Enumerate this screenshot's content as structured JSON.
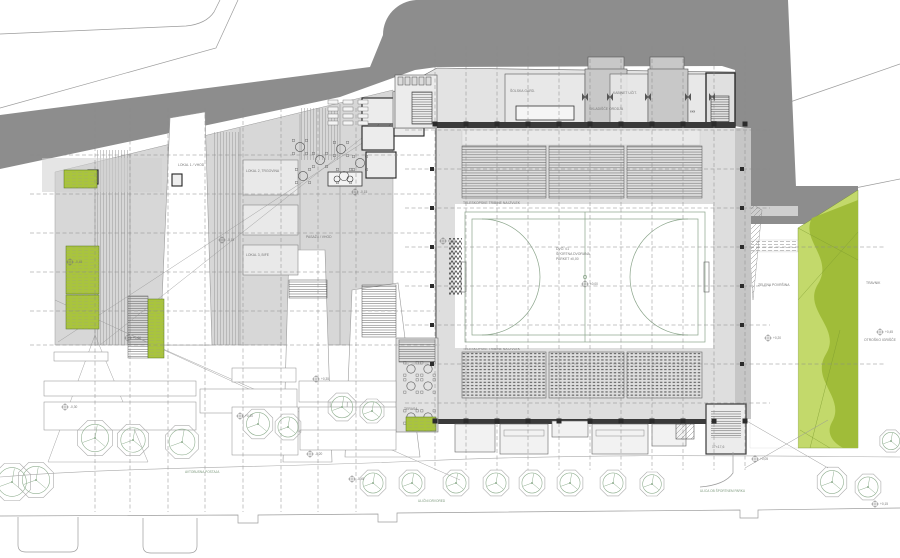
{
  "colors": {
    "road_dark": "#8d8d8d",
    "wing_gray": "#d7d7d7",
    "building_light": "#e3e3e3",
    "room_mid": "#c8c8c8",
    "hall_floor": "#dedede",
    "court_white": "#ffffff",
    "lime": "#a9c43d",
    "green_light": "#c3d96b",
    "green_dark": "#a0bc39",
    "wall_dark": "#3a3a3a",
    "tree_stroke": "#8fae8f"
  },
  "labels": {
    "bleachers_top": "TELESKOPSKE TRIBINE NA IZVLEK",
    "bleachers_bottom": "TELESKOPSKE TRIBINE NA IZVLEK",
    "court_line1": "DVO. 01",
    "court_line2": "ŠPORTNA DVORANA",
    "court_line3": "PARKET  ±0,00",
    "room_top_1": "ŠOLSKA GARD.",
    "room_top_2": "GARDEROBA UČENCI + PRHE",
    "room_top_3": "KABINET UČIT.",
    "room_top_4": "SKLADIŠČE ORODJA",
    "room_top_asterisks": "⁎⁎⁎",
    "wing_1": "LOKAL 1 / VHOD",
    "wing_2": "LOKAL 2, TRGOVINA",
    "wing_3": "LOKAL 3, BIFE",
    "wing_4": "PASAŽA / VHOD",
    "terrace": "TERASA",
    "stair_note": "17×17,6",
    "green_1": "ZELENA POVRŠINA",
    "green_2": "TRAVNIK",
    "green_3": "OTROŠKO IGRIŠČE",
    "street_1": "ULIČNI DRVORED",
    "street_2": "ULICA OB ŠPORTNEM PARKU",
    "street_3": "AVTOBUSNA POSTAJA"
  },
  "markers": [
    {
      "x": 70,
      "y": 262,
      "t": "-0,45"
    },
    {
      "x": 128,
      "y": 338,
      "t": "+0,00"
    },
    {
      "x": 222,
      "y": 240,
      "t": "-0,15"
    },
    {
      "x": 316,
      "y": 379,
      "t": "+0,35"
    },
    {
      "x": 355,
      "y": 192,
      "t": "-0,15"
    },
    {
      "x": 443,
      "y": 241,
      "t": "±0,00"
    },
    {
      "x": 585,
      "y": 284,
      "t": "±0,00"
    },
    {
      "x": 768,
      "y": 338,
      "t": "+0,20"
    },
    {
      "x": 880,
      "y": 332,
      "t": "+0,45"
    },
    {
      "x": 240,
      "y": 416,
      "t": "+0,10"
    },
    {
      "x": 65,
      "y": 407,
      "t": "-0,30"
    },
    {
      "x": 352,
      "y": 479,
      "t": "-0,45"
    },
    {
      "x": 755,
      "y": 459,
      "t": "+0,05"
    },
    {
      "x": 875,
      "y": 504,
      "t": "+0,15"
    },
    {
      "x": 310,
      "y": 454,
      "t": "-0,20"
    }
  ],
  "geometry": {
    "trees": [
      [
        12,
        482,
        20
      ],
      [
        36,
        480,
        19
      ],
      [
        95,
        438,
        19
      ],
      [
        133,
        440,
        17
      ],
      [
        182,
        442,
        18
      ],
      [
        258,
        424,
        16
      ],
      [
        288,
        427,
        14
      ],
      [
        342,
        407,
        15
      ],
      [
        372,
        411,
        13
      ],
      [
        373,
        483,
        14
      ],
      [
        412,
        483,
        14
      ],
      [
        456,
        483,
        14
      ],
      [
        496,
        483,
        14
      ],
      [
        532,
        483,
        14
      ],
      [
        570,
        483,
        14
      ],
      [
        613,
        483,
        14
      ],
      [
        652,
        484,
        13
      ],
      [
        832,
        482,
        16
      ],
      [
        868,
        487,
        14
      ],
      [
        891,
        441,
        12
      ]
    ],
    "grid_hall_x": {
      "xs": [
        435,
        466,
        497,
        528,
        559,
        590,
        621,
        652,
        683,
        714,
        745
      ],
      "y1": 46,
      "y2": 470
    },
    "grid_wing_x": {
      "xs": [
        95,
        130,
        168,
        205,
        243,
        281,
        318,
        356
      ],
      "y1": 108,
      "y2": 512
    },
    "grid_hall_y": {
      "ys": [
        130,
        169,
        208,
        286,
        325,
        403
      ],
      "x1": 405,
      "x2": 770
    },
    "grid_hall_y_ext": {
      "ys": [
        247,
        364
      ],
      "x1": 405,
      "x2": 885
    },
    "grid_wing_y": {
      "ys": [
        155,
        194,
        233,
        272,
        311,
        345
      ],
      "x1": 30,
      "x2": 440
    },
    "columns_x": [
      435,
      466,
      497,
      528,
      559,
      590,
      621,
      652,
      683,
      714,
      745
    ],
    "columns_y_rows": [
      124,
      421
    ],
    "columns_y": [
      169,
      208,
      247,
      286,
      325,
      364
    ],
    "columns_x_cols": [
      432,
      742
    ],
    "bleachers_top": [
      [
        462,
        146,
        84,
        52
      ],
      [
        549,
        146,
        75,
        52
      ],
      [
        627,
        146,
        75,
        52
      ]
    ],
    "bleachers_bottom": [
      [
        462,
        352,
        84,
        46
      ],
      [
        549,
        352,
        75,
        46
      ],
      [
        627,
        352,
        75,
        46
      ]
    ],
    "terrace_tables": [
      [
        411,
        369
      ],
      [
        428,
        369
      ],
      [
        411,
        386
      ],
      [
        428,
        386
      ],
      [
        411,
        417
      ],
      [
        428,
        417
      ]
    ],
    "foyer_tables": [
      [
        300,
        147
      ],
      [
        320,
        160
      ],
      [
        341,
        149
      ],
      [
        360,
        163
      ],
      [
        303,
        176
      ],
      [
        344,
        176
      ]
    ],
    "foyer_desks": {
      "xs": [
        328,
        343,
        358
      ],
      "ys": [
        100,
        107,
        114,
        121
      ],
      "w": 10,
      "h": 4
    },
    "planters": [
      [
        54,
        352,
        54,
        9
      ],
      [
        44,
        381,
        152,
        15
      ],
      [
        44,
        402,
        152,
        28
      ],
      [
        200,
        389,
        97,
        24
      ],
      [
        232,
        368,
        64,
        14
      ],
      [
        299,
        381,
        97,
        21
      ],
      [
        299,
        407,
        97,
        25
      ],
      [
        232,
        407,
        66,
        48
      ],
      [
        300,
        430,
        96,
        20
      ]
    ],
    "green_rects": [
      [
        64,
        170,
        33,
        18
      ],
      [
        66,
        246,
        33,
        48
      ],
      [
        66,
        295,
        33,
        34
      ],
      [
        148,
        299,
        16,
        59
      ],
      [
        406,
        417,
        30,
        14
      ]
    ],
    "bottom_blocks": [
      [
        455,
        424,
        40,
        28
      ],
      [
        500,
        424,
        48,
        30
      ],
      [
        552,
        421,
        36,
        16
      ],
      [
        592,
        424,
        56,
        30
      ],
      [
        652,
        424,
        34,
        22
      ]
    ]
  }
}
